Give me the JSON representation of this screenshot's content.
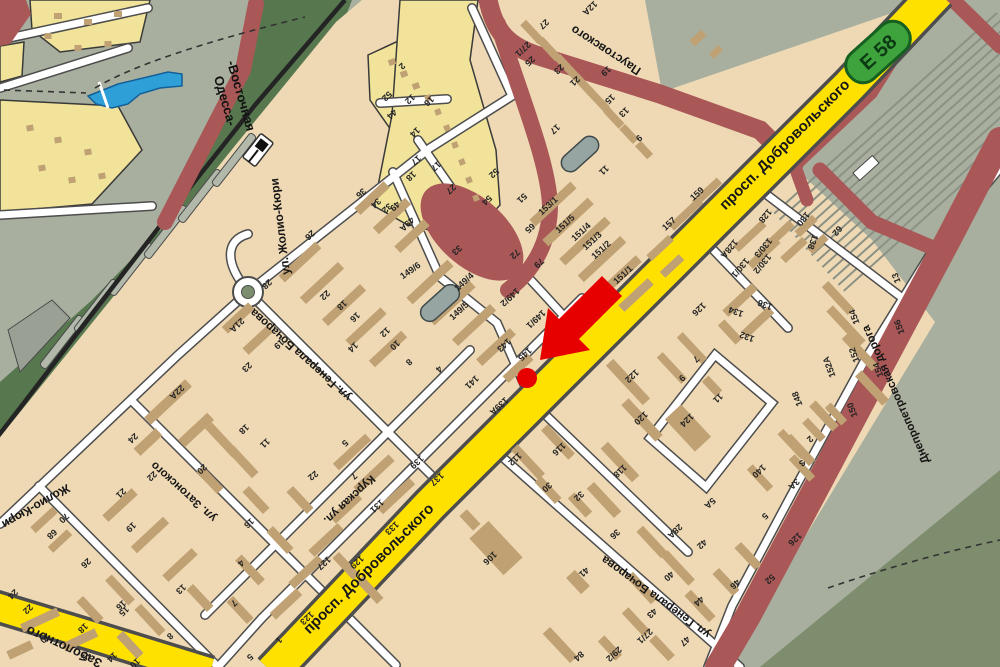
{
  "map": {
    "badge": {
      "label": "E 58",
      "fill": "#3fa33d",
      "border": "#155f20"
    },
    "marker": {
      "type": "route-destination-arrow",
      "color": "#e60000",
      "dot_building": "145"
    },
    "station": {
      "line1": "Одесса-",
      "line2": "-Восточная"
    },
    "colors": {
      "background": "#a8af9e",
      "residential": "#eed9b4",
      "residential_light": "#f1e49a",
      "building": "#c0a173",
      "forest": "#57784f",
      "military_green": "#7e8d6e",
      "red_road": "#aa5757",
      "highway_yellow": "#ffe100",
      "water": "#2f9fd8",
      "street_white": "#ffffff",
      "casing": "#4d4d4d"
    },
    "street_labels": [
      {
        "text": "просп. Добровольского",
        "x": 788,
        "y": 148,
        "rot": -45,
        "size": 15
      },
      {
        "text": "просп. Добровольского",
        "x": 372,
        "y": 572,
        "rot": -45,
        "size": 15
      },
      {
        "text": "Заболотного",
        "x": 66,
        "y": 643,
        "rot": 205,
        "size": 13
      },
      {
        "text": "ул. Жолио-Кюри",
        "x": 284,
        "y": 226,
        "rot": 263,
        "size": 12
      },
      {
        "text": "Жолио-Кюри",
        "x": 34,
        "y": 503,
        "rot": 150,
        "size": 12
      },
      {
        "text": "ул. Генерала Бочарова",
        "x": 303,
        "y": 352,
        "rot": 222,
        "size": 11.5
      },
      {
        "text": "ул. Генерала Бочарова",
        "x": 658,
        "y": 594,
        "rot": 216,
        "size": 11.5
      },
      {
        "text": "ул. Затонского",
        "x": 186,
        "y": 489,
        "rot": 222,
        "size": 11.5
      },
      {
        "text": "Курская ул.",
        "x": 347,
        "y": 497,
        "rot": 137,
        "size": 11.5
      },
      {
        "text": "Паустовского",
        "x": 608,
        "y": 47,
        "rot": 213,
        "size": 12
      },
      {
        "text": "Днепропетровская дорога",
        "x": 899,
        "y": 393,
        "rot": 246,
        "size": 11.5
      },
      {
        "text": "Одесса-",
        "x": 221,
        "y": 102,
        "rot": 74,
        "size": 13,
        "station": true
      },
      {
        "text": "-Восточная",
        "x": 237,
        "y": 97,
        "rot": 74,
        "size": 13,
        "station": true
      }
    ],
    "building_numbers": [
      [
        "2",
        400,
        64,
        137
      ],
      [
        "52",
        385,
        94,
        137
      ],
      [
        "12",
        408,
        97,
        137
      ],
      [
        "44",
        390,
        112,
        137
      ],
      [
        "16",
        427,
        99,
        137
      ],
      [
        "14",
        413,
        130,
        137
      ],
      [
        "17",
        434,
        164,
        137
      ],
      [
        "27",
        449,
        187,
        137
      ],
      [
        "52",
        492,
        171,
        137
      ],
      [
        "54",
        485,
        198,
        137
      ],
      [
        "51",
        520,
        196,
        137
      ],
      [
        "65",
        528,
        226,
        137
      ],
      [
        "33",
        455,
        248,
        137
      ],
      [
        "49А",
        405,
        222,
        137
      ],
      [
        "49",
        393,
        204,
        137
      ],
      [
        "32",
        385,
        206,
        137
      ],
      [
        "34",
        374,
        201,
        137
      ],
      [
        "36",
        359,
        191,
        137
      ],
      [
        "17",
        414,
        158,
        137
      ],
      [
        "18",
        409,
        174,
        137
      ],
      [
        "72",
        513,
        252,
        137
      ],
      [
        "79",
        537,
        261,
        137
      ],
      [
        "12А",
        588,
        6,
        137
      ],
      [
        "27",
        542,
        22,
        137
      ],
      [
        "27/1",
        521,
        47,
        137
      ],
      [
        "25",
        528,
        59,
        137
      ],
      [
        "23",
        557,
        67,
        137
      ],
      [
        "21",
        573,
        79,
        137
      ],
      [
        "19",
        604,
        69,
        137
      ],
      [
        "15",
        608,
        97,
        137
      ],
      [
        "13",
        622,
        110,
        137
      ],
      [
        "17",
        553,
        127,
        137
      ],
      [
        "9",
        637,
        136,
        137
      ],
      [
        "11",
        602,
        168,
        137
      ],
      [
        "153/1",
        550,
        208,
        -43
      ],
      [
        "151/5",
        567,
        226,
        -43
      ],
      [
        "151/4",
        583,
        234,
        -43
      ],
      [
        "151/3",
        594,
        243,
        -43
      ],
      [
        "151/2",
        603,
        252,
        -43
      ],
      [
        "151/1",
        625,
        277,
        -43
      ],
      [
        "157",
        671,
        226,
        -43
      ],
      [
        "159",
        699,
        196,
        -43
      ],
      [
        "149/6",
        412,
        273,
        -35
      ],
      [
        "149/4",
        466,
        284,
        -43
      ],
      [
        "149/5",
        461,
        313,
        -43
      ],
      [
        "149/2",
        508,
        295,
        137
      ],
      [
        "149/1",
        534,
        317,
        137
      ],
      [
        "143",
        502,
        343,
        137
      ],
      [
        "145",
        523,
        352,
        137
      ],
      [
        "141",
        470,
        380,
        137
      ],
      [
        "139А",
        497,
        404,
        137
      ],
      [
        "26",
        308,
        233,
        137
      ],
      [
        "28",
        265,
        282,
        137
      ],
      [
        "22",
        323,
        293,
        137
      ],
      [
        "18",
        340,
        303,
        137
      ],
      [
        "16",
        353,
        315,
        137
      ],
      [
        "14",
        351,
        345,
        137
      ],
      [
        "12",
        383,
        330,
        137
      ],
      [
        "10",
        393,
        343,
        137
      ],
      [
        "8",
        407,
        360,
        137
      ],
      [
        "4",
        437,
        367,
        137
      ],
      [
        "21А",
        235,
        323,
        137
      ],
      [
        "19",
        277,
        342,
        137
      ],
      [
        "23",
        245,
        365,
        137
      ],
      [
        "68",
        50,
        532,
        137
      ],
      [
        "70",
        62,
        516,
        137
      ],
      [
        "24",
        131,
        436,
        137
      ],
      [
        "22А",
        175,
        390,
        137
      ],
      [
        "22",
        150,
        474,
        137
      ],
      [
        "21",
        119,
        491,
        137
      ],
      [
        "20",
        200,
        467,
        137
      ],
      [
        "18",
        242,
        427,
        137
      ],
      [
        "11",
        263,
        441,
        137
      ],
      [
        "16",
        247,
        521,
        137
      ],
      [
        "19",
        129,
        525,
        137
      ],
      [
        "26",
        84,
        561,
        137
      ],
      [
        "13",
        179,
        587,
        137
      ],
      [
        "4",
        239,
        561,
        137
      ],
      [
        "7",
        232,
        601,
        137
      ],
      [
        "2",
        309,
        475,
        137
      ],
      [
        "15",
        122,
        609,
        137
      ],
      [
        "8",
        168,
        634,
        137
      ],
      [
        "24",
        11,
        592,
        137
      ],
      [
        "22",
        26,
        607,
        137
      ],
      [
        "18",
        81,
        626,
        137
      ],
      [
        "20",
        43,
        636,
        137
      ],
      [
        "12",
        84,
        654,
        137
      ],
      [
        "14",
        110,
        655,
        137
      ],
      [
        "16",
        119,
        603,
        137
      ],
      [
        "10",
        133,
        661,
        137
      ],
      [
        "1",
        277,
        638,
        137
      ],
      [
        "5",
        248,
        655,
        137
      ],
      [
        "5",
        343,
        441,
        137
      ],
      [
        "7",
        352,
        474,
        137
      ],
      [
        "2",
        313,
        472,
        137
      ],
      [
        "139",
        415,
        460,
        137
      ],
      [
        "137",
        435,
        477,
        137
      ],
      [
        "131",
        375,
        504,
        137
      ],
      [
        "133",
        390,
        526,
        137
      ],
      [
        "129",
        355,
        560,
        137
      ],
      [
        "127",
        322,
        561,
        137
      ],
      [
        "123",
        305,
        616,
        137
      ],
      [
        "112",
        513,
        457,
        137
      ],
      [
        "116",
        557,
        447,
        137
      ],
      [
        "30",
        545,
        485,
        137
      ],
      [
        "32",
        577,
        494,
        137
      ],
      [
        "106",
        488,
        556,
        137
      ],
      [
        "41",
        582,
        570,
        137
      ],
      [
        "84",
        577,
        654,
        137
      ],
      [
        "36",
        613,
        532,
        137
      ],
      [
        "40",
        667,
        574,
        137
      ],
      [
        "44",
        697,
        599,
        137
      ],
      [
        "46",
        733,
        582,
        137
      ],
      [
        "52",
        768,
        577,
        137
      ],
      [
        "43",
        650,
        611,
        137
      ],
      [
        "47",
        683,
        639,
        137
      ],
      [
        "27/1",
        643,
        634,
        137
      ],
      [
        "29/2",
        612,
        652,
        137
      ],
      [
        "28А",
        673,
        529,
        137
      ],
      [
        "42",
        700,
        542,
        137
      ],
      [
        "5",
        763,
        514,
        137
      ],
      [
        "5А",
        708,
        501,
        137
      ],
      [
        "126",
        793,
        537,
        137
      ],
      [
        "2",
        808,
        437,
        137
      ],
      [
        "3",
        800,
        461,
        137
      ],
      [
        "3А",
        792,
        482,
        137
      ],
      [
        "150",
        855,
        409,
        250
      ],
      [
        "140",
        757,
        469,
        137
      ],
      [
        "148",
        800,
        398,
        250
      ],
      [
        "152",
        857,
        354,
        250
      ],
      [
        "152А",
        832,
        366,
        250
      ],
      [
        "154",
        857,
        316,
        250
      ],
      [
        "156",
        902,
        326,
        250
      ],
      [
        "154",
        881,
        369,
        250
      ],
      [
        "122",
        630,
        374,
        137
      ],
      [
        "120",
        639,
        416,
        137
      ],
      [
        "118",
        618,
        469,
        137
      ],
      [
        "124",
        685,
        418,
        137
      ],
      [
        "11",
        716,
        396,
        137
      ],
      [
        "9",
        680,
        376,
        137
      ],
      [
        "7",
        694,
        357,
        137
      ],
      [
        "126",
        697,
        307,
        137
      ],
      [
        "134",
        737,
        309,
        200
      ],
      [
        "136",
        766,
        302,
        200
      ],
      [
        "132",
        748,
        334,
        200
      ],
      [
        "128",
        763,
        214,
        130
      ],
      [
        "128А",
        727,
        247,
        130
      ],
      [
        "130/1",
        738,
        266,
        130
      ],
      [
        "130/3",
        761,
        246,
        130
      ],
      [
        "130/2",
        760,
        262,
        130
      ],
      [
        "130",
        801,
        217,
        130
      ],
      [
        "138",
        810,
        241,
        110
      ],
      [
        "62",
        835,
        229,
        130
      ],
      [
        "13",
        899,
        277,
        250
      ]
    ]
  }
}
